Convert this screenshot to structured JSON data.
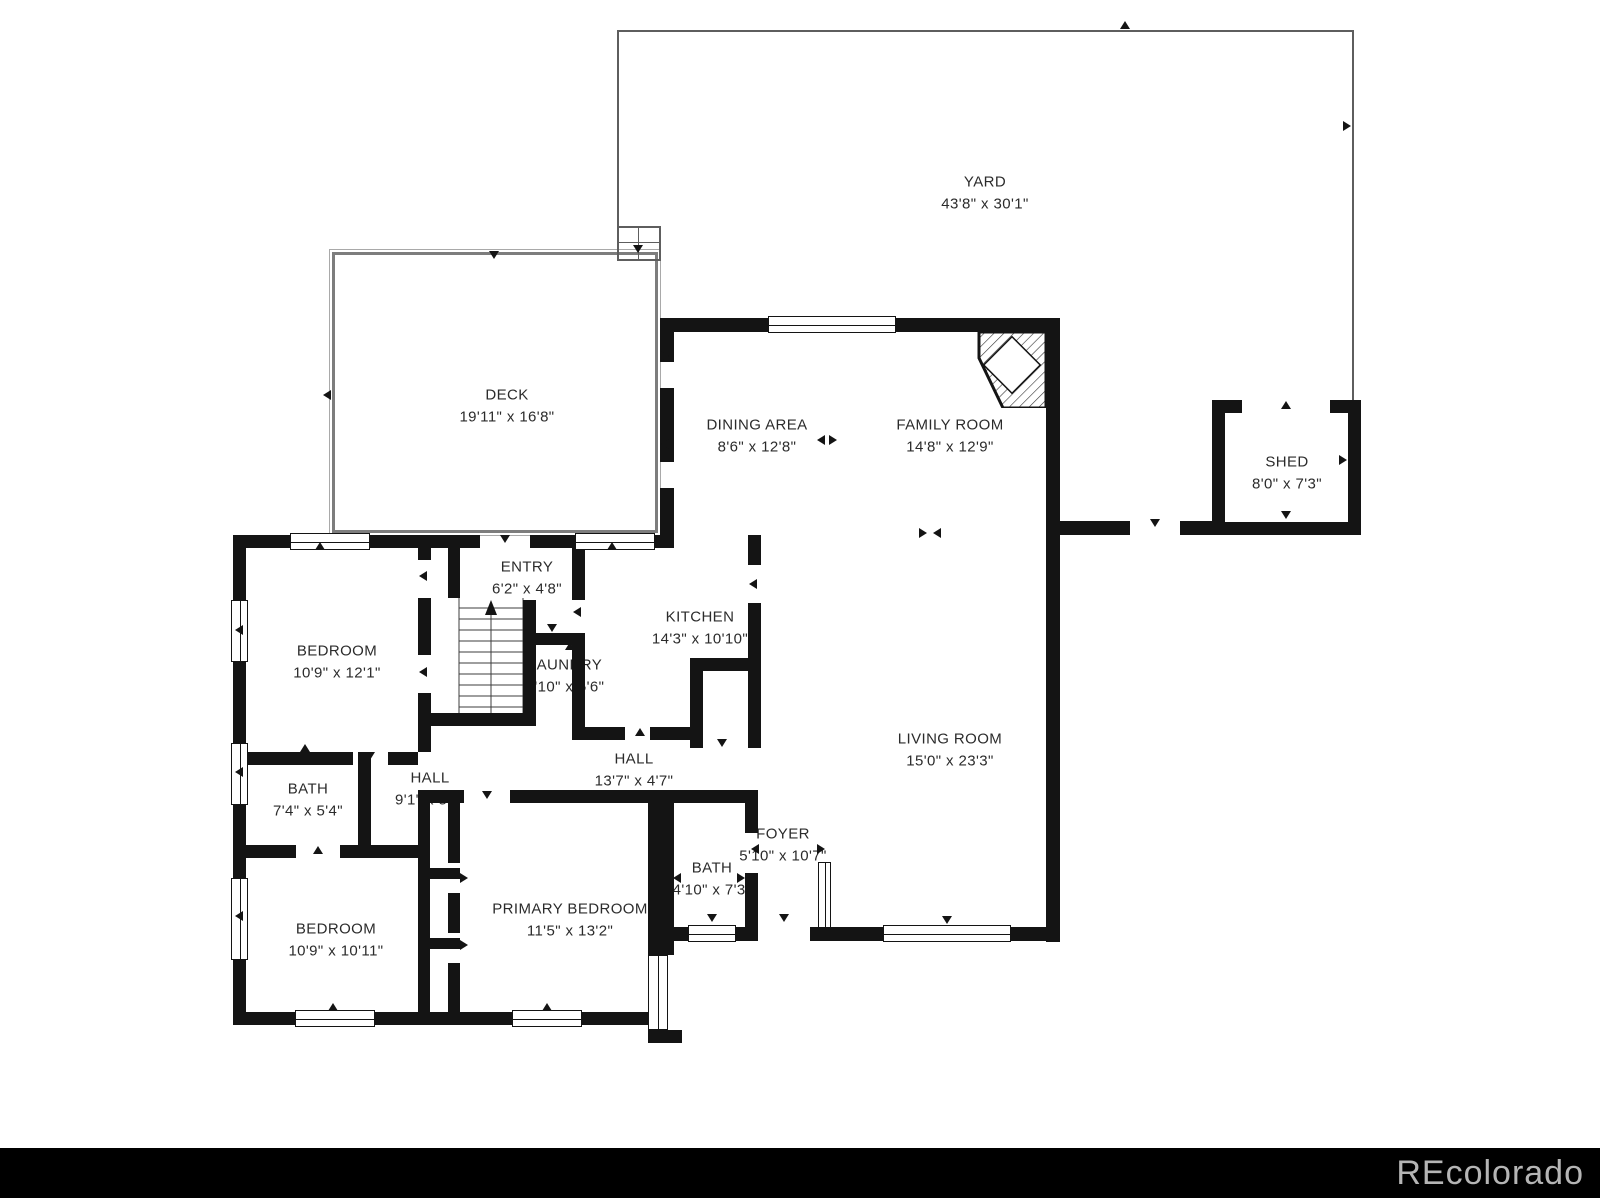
{
  "footer": {
    "watermark": "REcolorado"
  },
  "colors": {
    "wall": "#141414",
    "outline_thin": "#5e5e5e",
    "deck_border": "#7d7d7d",
    "watermark_bar": "#000000",
    "watermark_text": "#b5b5b5",
    "label_text": "#2b2b2b"
  },
  "rooms": {
    "yard": {
      "name": "YARD",
      "dims": "43'8\" x 30'1\""
    },
    "deck": {
      "name": "DECK",
      "dims": "19'11\" x 16'8\""
    },
    "dining_area": {
      "name": "DINING AREA",
      "dims": "8'6\" x 12'8\""
    },
    "family_room": {
      "name": "FAMILY ROOM",
      "dims": "14'8\" x 12'9\""
    },
    "shed": {
      "name": "SHED",
      "dims": "8'0\" x 7'3\""
    },
    "entry": {
      "name": "ENTRY",
      "dims": "6'2\" x 4'8\""
    },
    "kitchen": {
      "name": "KITCHEN",
      "dims": "14'3\" x 10'10\""
    },
    "bedroom_upper": {
      "name": "BEDROOM",
      "dims": "10'9\" x 12'1\""
    },
    "laundry": {
      "name": "LAUNDRY",
      "dims": "5'10\" x 5'6\""
    },
    "hall_west": {
      "name": "HALL",
      "dims": "9'1\" x 5'4\""
    },
    "hall_center": {
      "name": "HALL",
      "dims": "13'7\" x 4'7\""
    },
    "bath_west": {
      "name": "BATH",
      "dims": "7'4\" x 5'4\""
    },
    "living_room": {
      "name": "LIVING ROOM",
      "dims": "15'0\" x 23'3\""
    },
    "bedroom_lower": {
      "name": "BEDROOM",
      "dims": "10'9\" x 10'11\""
    },
    "primary_bedroom": {
      "name": "PRIMARY BEDROOM",
      "dims": "11'5\" x 13'2\""
    },
    "bath_center": {
      "name": "BATH",
      "dims": "4'10\" x 7'3\""
    },
    "foyer": {
      "name": "FOYER",
      "dims": "5'10\" x 10'7\""
    }
  }
}
